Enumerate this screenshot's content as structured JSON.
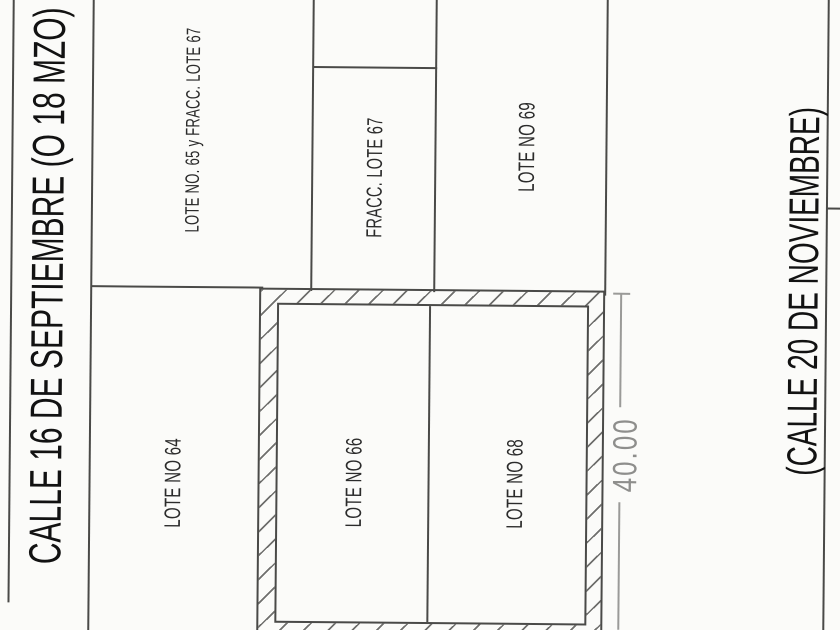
{
  "drawing": {
    "streets": {
      "left": "CALLE 16 DE SEPTIEMBRE (O 18 MZO)",
      "right": "(CALLE 20 DE NOVIEMBRE)"
    },
    "lots": {
      "lote65_fracc67": "LOTE NO. 65 y FRACC. LOTE 67",
      "fracc67": "FRACC. LOTE 67",
      "lote69": "LOTE NO 69",
      "lote64": "LOTE NO 64",
      "lote66": "LOTE NO 66",
      "lote68": "LOTE NO 68"
    },
    "dimension": {
      "depth": "40.00"
    },
    "colors": {
      "background": "#fbfbf9",
      "line": "#4a4a48",
      "hatch": "#6f6f6d",
      "label": "#2b2b2b",
      "street": "#121212",
      "dimtext": "#8e8e8c",
      "dimline": "#9a9a98"
    }
  }
}
